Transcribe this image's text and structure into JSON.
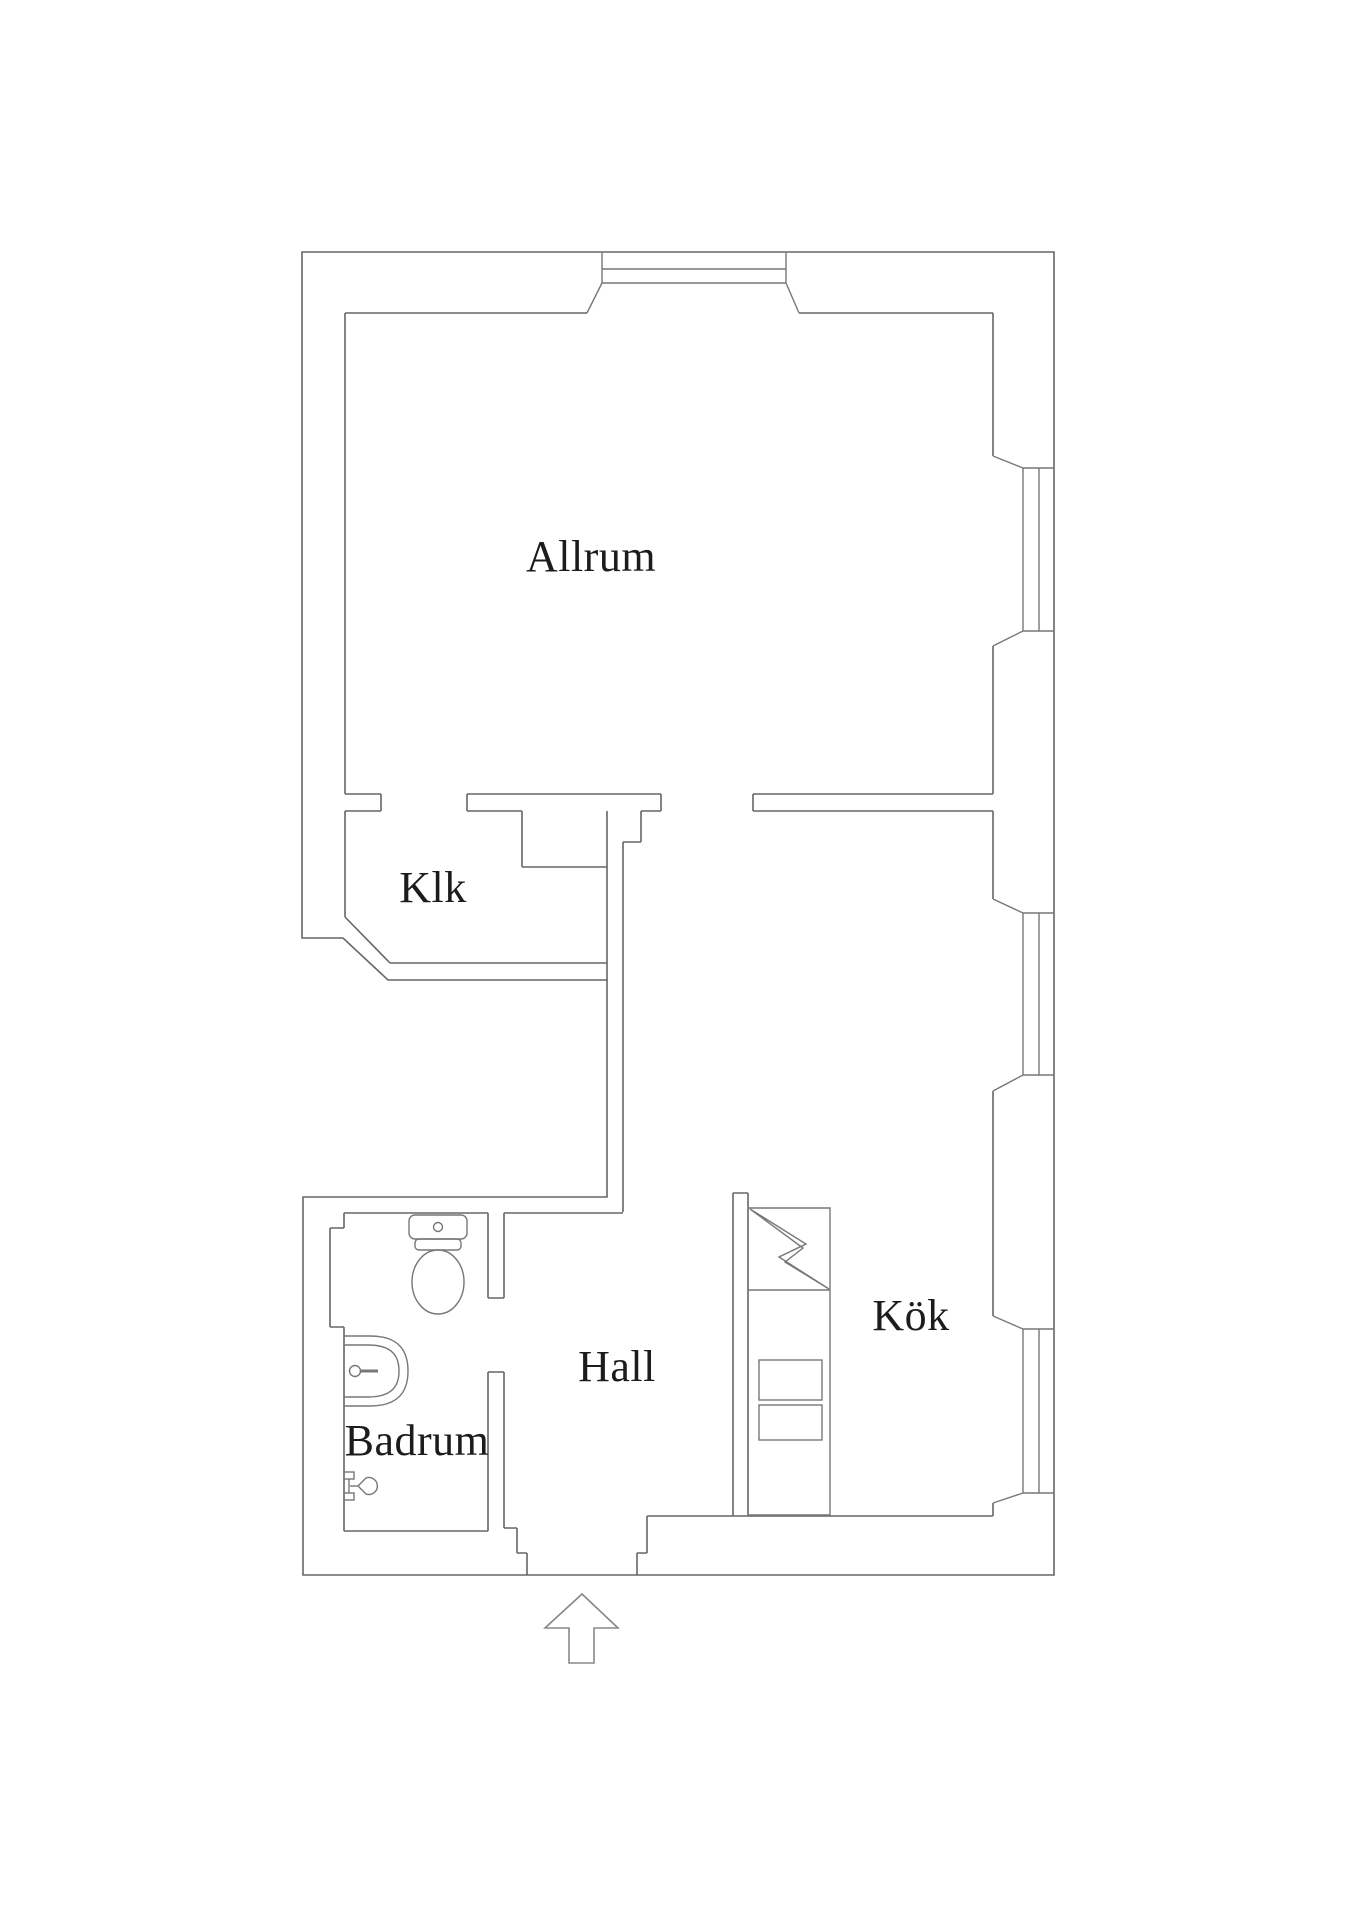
{
  "plan": {
    "type": "apartment-floor-plan",
    "rooms": [
      {
        "id": "allrum",
        "label": "Allrum"
      },
      {
        "id": "klk",
        "label": "Klk"
      },
      {
        "id": "hall",
        "label": "Hall"
      },
      {
        "id": "kok",
        "label": "Kök"
      },
      {
        "id": "badrum",
        "label": "Badrum"
      }
    ],
    "fixtures": [
      "toilet-icon",
      "sink-icon",
      "shower-mixer-icon",
      "kitchen-unit-with-lightning-icon",
      "drawer-icons",
      "bay-window-icon",
      "right-window-icons",
      "entrance-arrow-icon"
    ],
    "colors": {
      "background": "#ffffff",
      "wall_line": "#666666",
      "fixture_line": "#777777",
      "arrow_line": "#888888",
      "text": "#1c1c1c"
    }
  }
}
